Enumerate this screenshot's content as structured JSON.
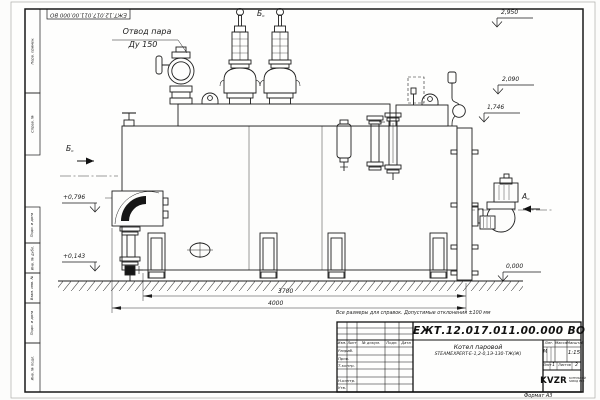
{
  "sheet": {
    "designation": "ЕЖТ.12.017.011.00.000 ВО",
    "format_label": "Формат А3",
    "note": "Все размеры для справок. Допустимые отклонения ±100 мм"
  },
  "margin_labels": [
    "Перв. примен.",
    "Справ. №",
    "Подп. и дата",
    "Инв. № дубл.",
    "Взам. инв. №",
    "Подп. и дата",
    "Инв. № подл."
  ],
  "annotations": {
    "steam_outlet_line1": "Отвод пара",
    "steam_outlet_line2": "Ду 150",
    "view_a": "А",
    "view_b_left": "Б",
    "view_b_top": "Б",
    "view_suffix": "o",
    "elevations": {
      "e2950": "2,950",
      "e2090": "2,090",
      "e1746": "1,746",
      "e0": "0,000",
      "e796": "+0,796",
      "e143": "+0,143"
    },
    "dims": {
      "d3700": "3700",
      "d4000": "4000"
    }
  },
  "title_block": {
    "designation": "ЕЖТ.12.017.011.00.000 ВО",
    "name_line1": "Котел паровой",
    "name_line2": "STEAMEXPERT-Е-1,2-0,1Э-130-ТЖ(Ж)",
    "col_izm": "Изм.",
    "col_list": "Лист",
    "col_doc": "№ докум.",
    "col_podp": "Подп.",
    "col_data": "Дата",
    "row_razrab": "Разраб.",
    "row_prov": "Пров.",
    "row_tkontr": "Т.контр.",
    "row_nkontr": "Н.контр.",
    "row_utv": "Утв.",
    "lit_header": "Лит.",
    "massa_header": "Масса",
    "masshtab_header": "Масштаб",
    "lit_value": "М",
    "scale_value": "1:15",
    "list_label": "Лист",
    "list_value": "1",
    "listov_label": "Листов",
    "listov_value": "2",
    "logo_text": "KVZR",
    "logo_sub1": "КОТЕЛЬНЫЙ",
    "logo_sub2": "ЗАВОД РЭП"
  }
}
